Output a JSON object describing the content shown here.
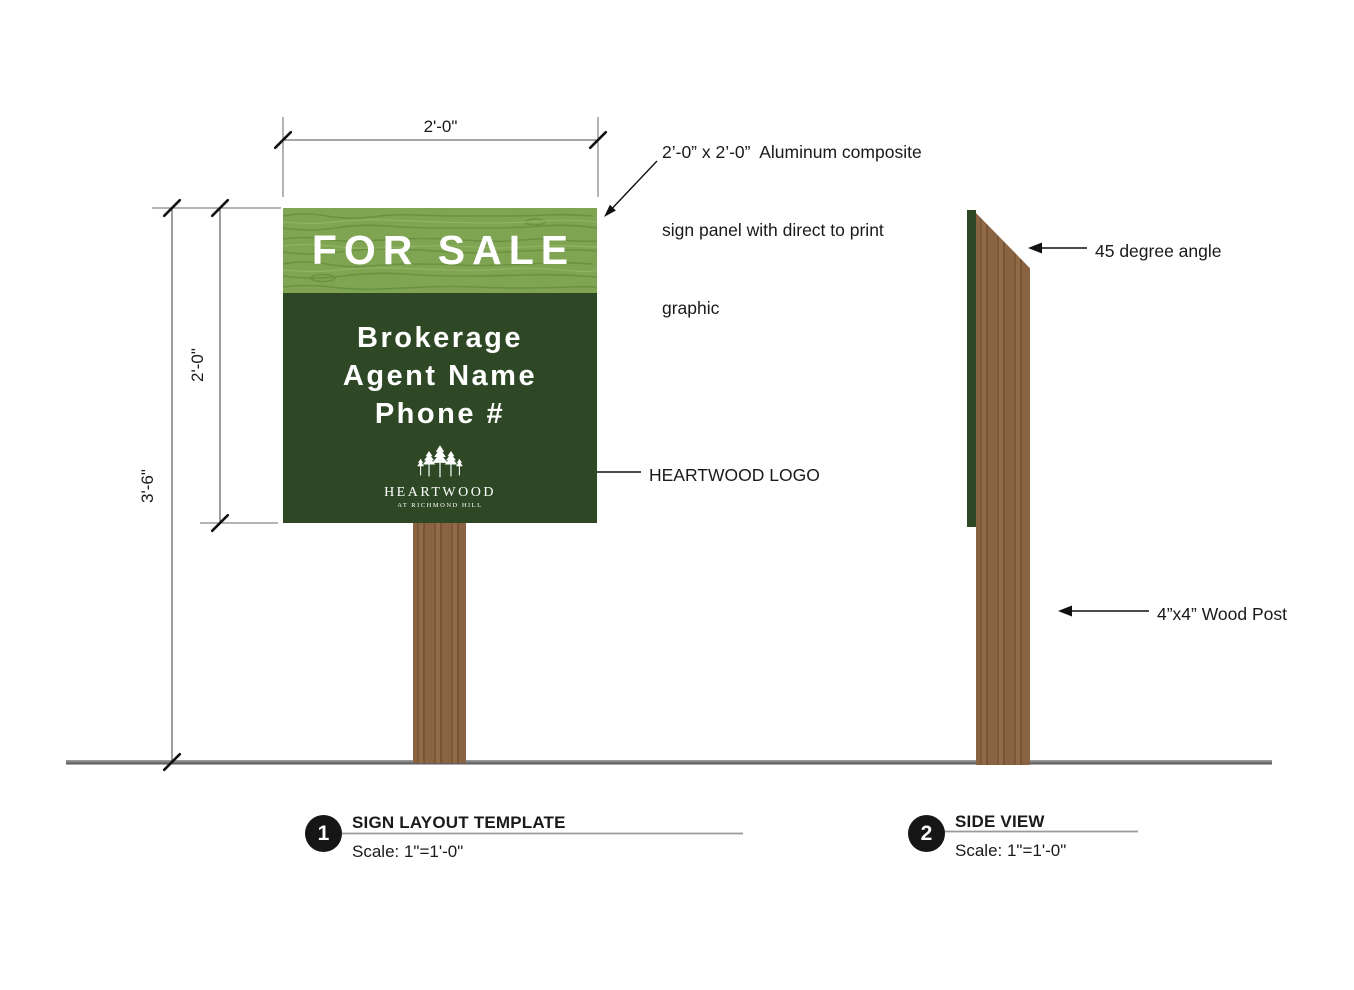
{
  "sign": {
    "headline": "FOR SALE",
    "lines": [
      "Brokerage",
      "Agent Name",
      "Phone #"
    ],
    "logo_name": "HEARTWOOD",
    "logo_tagline": "AT RICHMOND HILL"
  },
  "dimensions": {
    "width": "2'-0\"",
    "sign_height": "2'-0\"",
    "total_height": "3'-6\""
  },
  "annotations": {
    "panel_note_line1": "2’-0” x 2’-0”  Aluminum composite",
    "panel_note_line2": "sign panel with direct to print",
    "panel_note_line3": "graphic",
    "logo_note": "HEARTWOOD LOGO",
    "angle_note": "45 degree angle",
    "post_note": "4”x4” Wood Post"
  },
  "callouts": [
    {
      "number": "1",
      "title": "SIGN LAYOUT TEMPLATE",
      "scale": "Scale: 1\"=1'-0\""
    },
    {
      "number": "2",
      "title": "SIDE VIEW",
      "scale": "Scale: 1\"=1'-0\""
    }
  ],
  "colors": {
    "header_green": "#7fa452",
    "grain_dark": "#6b9242",
    "grain_light": "#93b565",
    "body_green": "#2e4826",
    "post_brown": "#8a6342",
    "ground_gray": "#6e6e6e"
  }
}
